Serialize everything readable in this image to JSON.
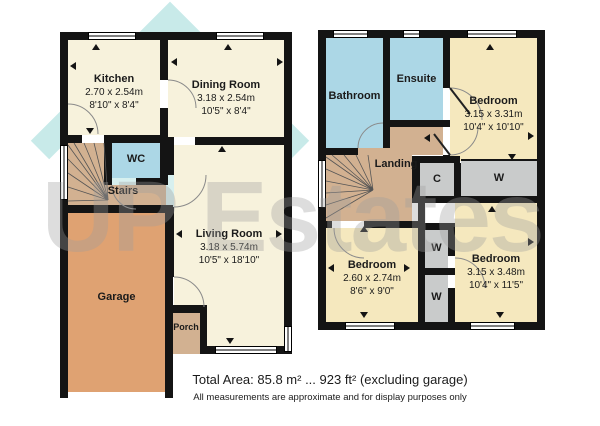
{
  "watermark": {
    "text": "UP Estates",
    "logo": "house-icon",
    "logo_color": "#6EC8C4",
    "text_color": "#9E9E9E"
  },
  "footer": {
    "total_area": "Total Area: 85.8 m² ... 923 ft² (excluding garage)",
    "disclaimer": "All measurements are approximate and for display purposes only"
  },
  "colors": {
    "wall": "#141414",
    "reception_room": "#F7F2DC",
    "bedroom": "#F5E8BE",
    "bathroom": "#ACD7E6",
    "hall_stairs": "#D2B191",
    "garage": "#DFA272",
    "closet": "#C9CBCB"
  },
  "floors": {
    "ground": {
      "rooms": [
        {
          "id": "kitchen",
          "name": "Kitchen",
          "dims_m": "2.70 x 2.54m",
          "dims_ft": "8'10\" x 8'4\""
        },
        {
          "id": "dining",
          "name": "Dining Room",
          "dims_m": "3.18 x 2.54m",
          "dims_ft": "10'5\" x 8'4\""
        },
        {
          "id": "wc",
          "name": "WC"
        },
        {
          "id": "stairs",
          "name": "Stairs"
        },
        {
          "id": "living",
          "name": "Living Room",
          "dims_m": "3.18 x 5.74m",
          "dims_ft": "10'5\" x 18'10\""
        },
        {
          "id": "garage",
          "name": "Garage"
        },
        {
          "id": "porch",
          "name": "Porch"
        }
      ]
    },
    "first": {
      "rooms": [
        {
          "id": "bathroom",
          "name": "Bathroom"
        },
        {
          "id": "ensuite",
          "name": "Ensuite"
        },
        {
          "id": "bedroom1",
          "name": "Bedroom",
          "dims_m": "3.15 x 3.31m",
          "dims_ft": "10'4\" x 10'10\""
        },
        {
          "id": "landing",
          "name": "Landing"
        },
        {
          "id": "cupboard",
          "name": "C"
        },
        {
          "id": "wardrobe1",
          "name": "W"
        },
        {
          "id": "bedroom2",
          "name": "Bedroom",
          "dims_m": "2.60 x 2.74m",
          "dims_ft": "8'6\" x 9'0\""
        },
        {
          "id": "wardrobe2",
          "name": "W"
        },
        {
          "id": "wardrobe3",
          "name": "W"
        },
        {
          "id": "bedroom3",
          "name": "Bedroom",
          "dims_m": "3.15 x 3.48m",
          "dims_ft": "10'4\" x 11'5\""
        }
      ]
    }
  }
}
